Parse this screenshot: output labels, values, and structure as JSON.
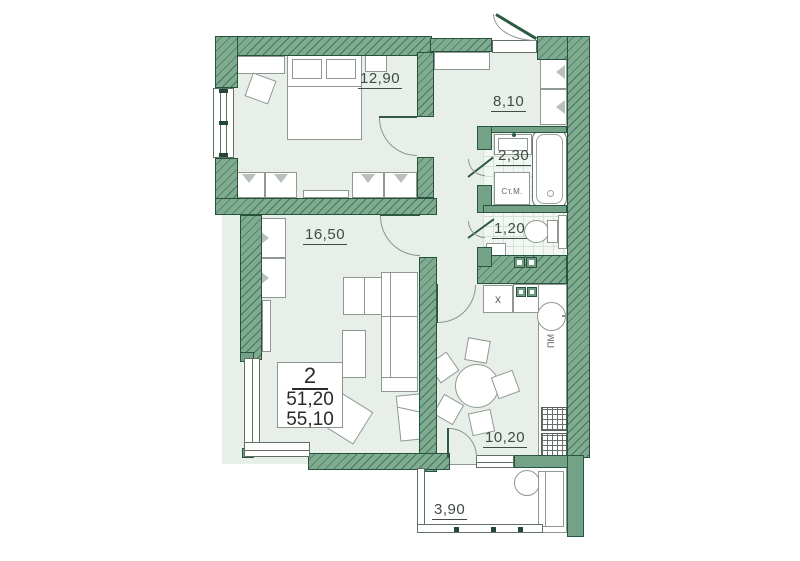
{
  "unit": {
    "rooms_count": "2",
    "living_area": "51,20",
    "total_area": "55,10"
  },
  "rooms": {
    "bedroom": {
      "area": "12,90"
    },
    "hallway": {
      "area": "8,10"
    },
    "bathroom": {
      "area": "2,30"
    },
    "wc": {
      "area": "1,20"
    },
    "living": {
      "area": "16,50"
    },
    "kitchen": {
      "area": "10,20"
    },
    "balcony": {
      "area": "3,90"
    }
  },
  "appliances": {
    "washing_machine": "Ст.М.",
    "dishwasher": "ПМ",
    "fridge": "x"
  },
  "colors": {
    "wall": "#7fab91",
    "wall_hatch": "#1b4733",
    "partition": "#74a287",
    "floor": "#e8efe9",
    "tile": "#f3f7f3",
    "furniture_outline": "#8f9893",
    "text": "#414b44"
  }
}
